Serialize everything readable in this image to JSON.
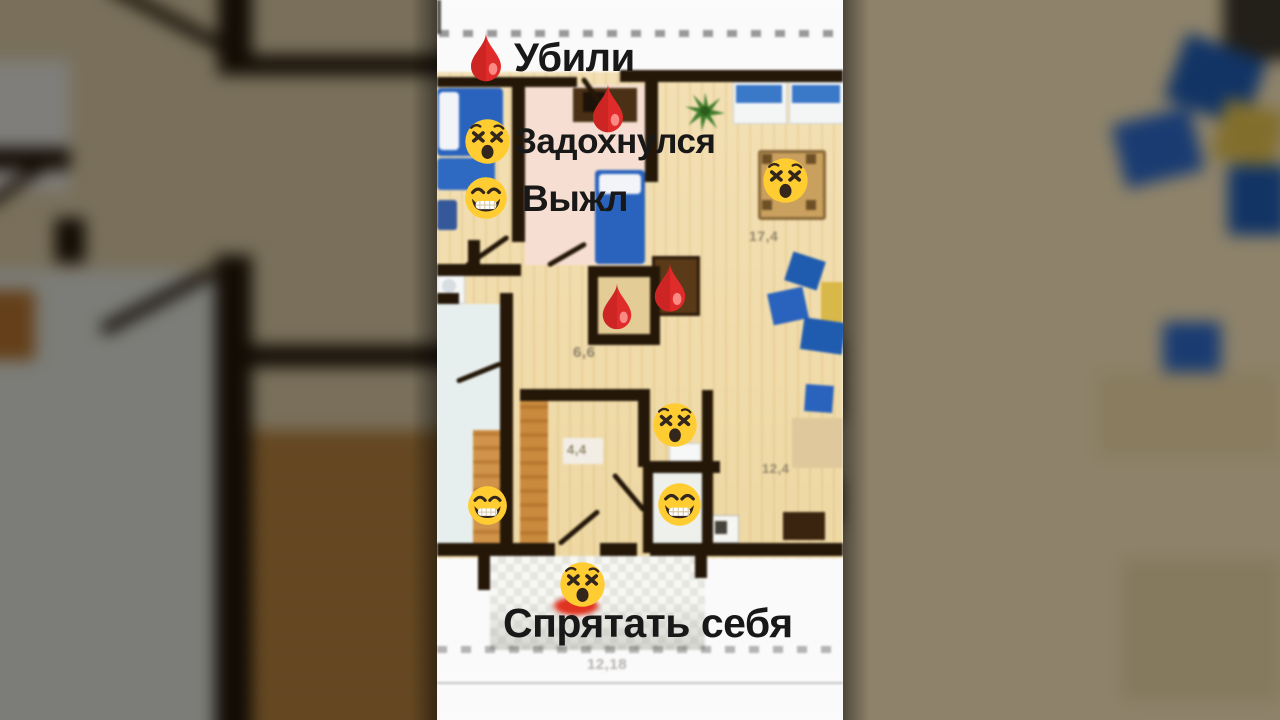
{
  "frame": {
    "kind": "vertical-video-frame-over-floor-plan",
    "background_color": "#6b6355"
  },
  "captions": {
    "killed": "Убили",
    "suffocated": "Задохнулся",
    "survived": "Выжл",
    "hide_yourself": "Спрятать себя"
  },
  "floor_plan": {
    "room_dimensions": {
      "living_room": "17,4",
      "hall": "6,6",
      "corridor": "4,4",
      "kitchen": "12,4",
      "bottom_width": "12,18"
    }
  },
  "icons": {
    "blood_drop": "blood-drop-emoji",
    "dizzy_face": "dizzy-face-emoji",
    "grin_face": "grin-face-emoji",
    "plant": "plant-icon"
  },
  "icon_counts": {
    "blood_drop": 4,
    "dizzy_face": 4,
    "grin_face": 3
  },
  "colors": {
    "caption_text": "#181818",
    "wall": "#241708",
    "floor_wood": "#f1dcae",
    "floor_pink": "#f6dfd2",
    "floor_bath": "#e7efee",
    "furniture_blue": "#2a63bd",
    "table_yellow": "#d9b84a",
    "blood_red": "#dd2b27",
    "emoji_yellow": "#ffcc32",
    "plant_green": "#3f7d2a"
  }
}
